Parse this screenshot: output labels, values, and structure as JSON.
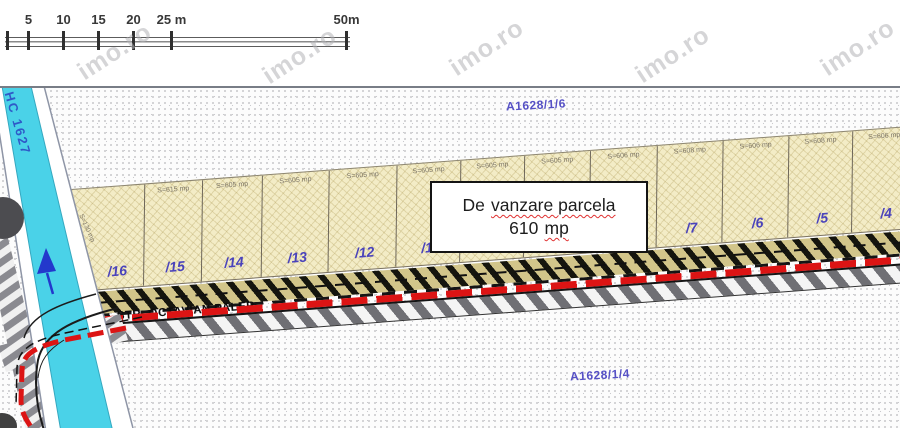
{
  "scale_bar": {
    "ticks": [
      {
        "label": "",
        "x": 6
      },
      {
        "label": "5",
        "x": 27
      },
      {
        "label": "10",
        "x": 62
      },
      {
        "label": "15",
        "x": 97
      },
      {
        "label": "20",
        "x": 132
      },
      {
        "label": "25 m",
        "x": 170
      },
      {
        "label": "50m",
        "x": 345
      }
    ]
  },
  "watermark": {
    "text": "imo.ro"
  },
  "canal": {
    "label": "HC 1627"
  },
  "fields": {
    "top": "A1628/1/6",
    "bottom": "A1628/1/4"
  },
  "street": {
    "name": "STR. OCTAVIAN PALER"
  },
  "sale_box": {
    "prefix": "De",
    "underlined": "vanzare parcela",
    "value": "610",
    "unit": "mp"
  },
  "parcels": [
    {
      "number": "/16",
      "area": "S=130 mp"
    },
    {
      "number": "/15",
      "area": "S=615 mp"
    },
    {
      "number": "/14",
      "area": "S=605 mp"
    },
    {
      "number": "/13",
      "area": "S=605 mp"
    },
    {
      "number": "/12",
      "area": "S=605 mp"
    },
    {
      "number": "/11",
      "area": "S=605 mp"
    },
    {
      "number": "/10",
      "area": "S=605 mp"
    },
    {
      "number": "/9",
      "area": "S=605 mp"
    },
    {
      "number": "/8",
      "area": "S=606 mp"
    },
    {
      "number": "/7",
      "area": "S=608 mp"
    },
    {
      "number": "/6",
      "area": "S=606 mp"
    },
    {
      "number": "/5",
      "area": "S=608 mp"
    },
    {
      "number": "/4",
      "area": "S=606 mp"
    }
  ],
  "colors": {
    "canal": "#4ad2e8",
    "parcel_fill": "#f3ecc6",
    "route_red": "#dc1414",
    "label_blue": "#4a43bb",
    "field_label_blue": "#5550c5"
  }
}
